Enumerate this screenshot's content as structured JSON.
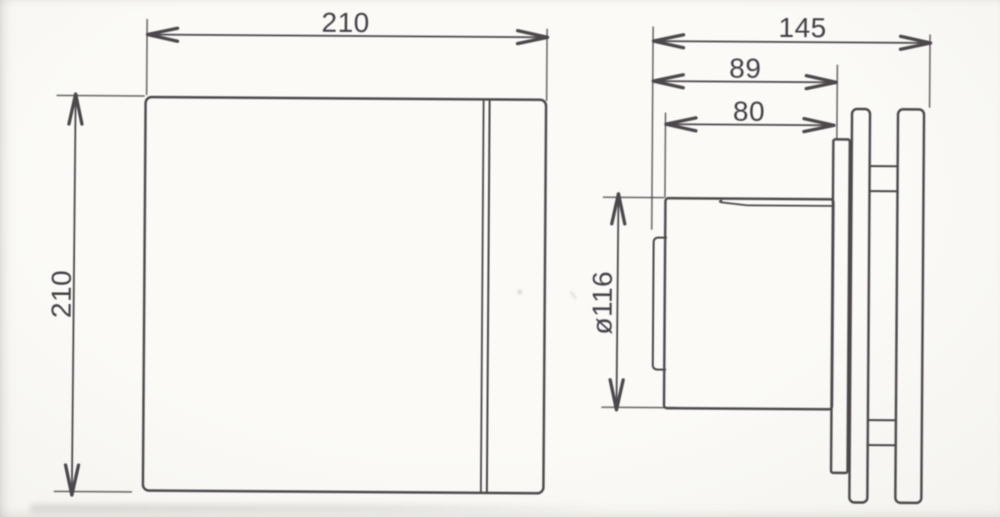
{
  "front_view": {
    "width_label": "210",
    "height_label": "210"
  },
  "side_view": {
    "depth_label": "145",
    "mount_depth_label": "89",
    "duct_length_label": "80",
    "duct_diameter_label": "ø116"
  },
  "colors": {
    "line": "#4c474b",
    "text": "#444046",
    "bg": "#f8f7f4"
  }
}
